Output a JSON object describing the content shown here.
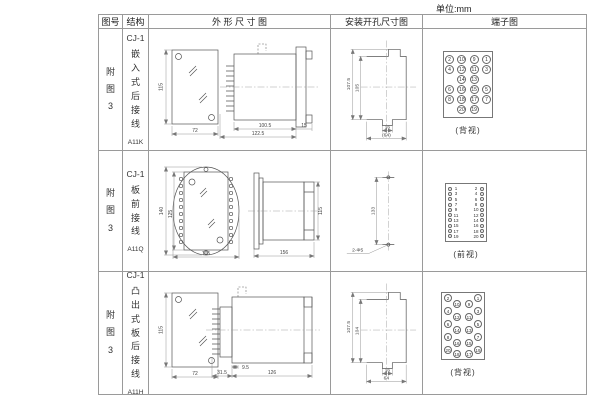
{
  "unit_label": "单位:mm",
  "headers": {
    "fig": "图号",
    "structure": "结构",
    "outline": "外 形 尺 寸 图",
    "mounting": "安装开孔尺寸图",
    "terminal": "端子图"
  },
  "rows": [
    {
      "fig_no": "附图3",
      "model": "CJ-1",
      "desc": "嵌入式后接线",
      "code": "A11K",
      "outline": {
        "h": "115",
        "w": "72",
        "body": "100.5",
        "total": "122.5",
        "flange": "15"
      },
      "mount": {
        "outer": "107.5",
        "inner": "105",
        "hole": "16",
        "span": "(64)"
      },
      "terminal_view": "(背视)",
      "terminals": [
        [
          "2",
          "10",
          "9",
          "1"
        ],
        [
          "4",
          "12",
          "11",
          "3"
        ],
        [
          "",
          "14",
          "13",
          ""
        ],
        [
          "6",
          "16",
          "15",
          "5"
        ],
        [
          "8",
          "18",
          "17",
          "7"
        ],
        [
          "",
          "20",
          "19",
          ""
        ]
      ]
    },
    {
      "fig_no": "附图3",
      "model": "CJ-1",
      "desc": "板前接线",
      "code": "A11Q",
      "outline": {
        "outer_h": "140",
        "inner_h": "125",
        "w": "105",
        "len": "156",
        "side_h": "115"
      },
      "mount": {
        "pitch": "133",
        "holes": "2-Φ5"
      },
      "terminal_view": "(前视)",
      "terminals": [
        [
          "1",
          "2"
        ],
        [
          "3",
          "4"
        ],
        [
          "5",
          "6"
        ],
        [
          "7",
          "8"
        ],
        [
          "9",
          "10"
        ],
        [
          "11",
          "12"
        ],
        [
          "13",
          "14"
        ],
        [
          "15",
          "16"
        ],
        [
          "17",
          "18"
        ],
        [
          "19",
          "20"
        ]
      ]
    },
    {
      "fig_no": "附图3",
      "model": "CJ-1",
      "desc": "凸出式板后接线",
      "code": "A11H",
      "outline": {
        "h": "115",
        "w": "72",
        "pin": "9.5",
        "socket": "31.5",
        "body": "126"
      },
      "mount": {
        "outer": "107.5",
        "inner": "104",
        "hole": "16",
        "span": "64"
      },
      "terminal_view": "(背视)",
      "terminals": {
        "left_outer": [
          "2",
          "4",
          "6",
          "8",
          "20"
        ],
        "left_inner": [
          "10",
          "12",
          "14",
          "16",
          "18"
        ],
        "right_inner": [
          "9",
          "11",
          "13",
          "15",
          "17"
        ],
        "right_outer": [
          "1",
          "3",
          "5",
          "7",
          "19"
        ]
      }
    }
  ]
}
